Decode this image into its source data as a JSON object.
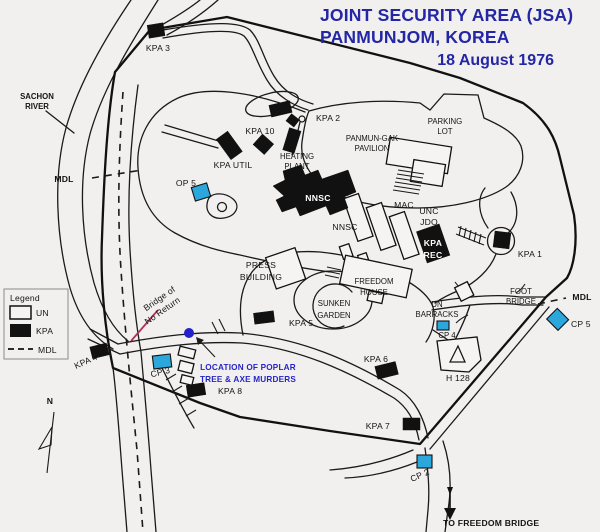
{
  "title": {
    "line1": "JOINT SECURITY AREA (JSA)",
    "line2": "PANMUNJOM, KOREA",
    "date": "18 August 1976"
  },
  "legend": {
    "title": "Legend",
    "un": "UN",
    "kpa": "KPA",
    "mdl": "MDL"
  },
  "compass": {
    "north": "N"
  },
  "labels": {
    "kpa3": "KPA 3",
    "sachon1": "SACHON",
    "sachon2": "RIVER",
    "mdl_left": "MDL",
    "kpa2": "KPA 2",
    "kpa10": "KPA 10",
    "kpa_util": "KPA UTIL",
    "heating1": "HEATING",
    "heating2": "PLANT",
    "panmungak1": "PANMUN-GAK",
    "panmungak2": "PAVILION",
    "parking1": "PARKING",
    "parking2": "LOT",
    "op5": "OP 5",
    "nnsc_main": "NNSC",
    "nnsc_row": "NNSC",
    "mac": "MAC",
    "unc": "UNC",
    "jdo": "JDO",
    "kpa_rec1": "KPA",
    "kpa_rec2": "REC",
    "kpa1": "KPA 1",
    "press1": "PRESS",
    "press2": "BUILDING",
    "freedom1": "FREEDOM",
    "freedom2": "HOUSE",
    "sunken1": "SUNKEN",
    "sunken2": "GARDEN",
    "foot1": "FOOT",
    "foot2": "BRIDGE",
    "mdl_right": "MDL",
    "cp5": "CP 5",
    "un_barracks1": "UN",
    "un_barracks2": "BARRACKS",
    "cp4": "CP 4",
    "h128": "H 128",
    "kpa5": "KPA 5",
    "kpa6": "KPA 6",
    "kpa4": "KPA 4",
    "cp3": "CP 3",
    "kpa8": "KPA 8",
    "kpa7": "KPA 7",
    "cp2": "CP 2",
    "bridge1": "Bridge of",
    "bridge2": "No Return",
    "poplar1": "LOCATION OF POPLAR",
    "poplar2": "TREE & AXE MURDERS",
    "to_freedom_bridge": "TO FREEDOM BRIDGE"
  },
  "colors": {
    "background": "#f2f0ee",
    "title_blue": "#2326a5",
    "annotation_blue": "#2525c6",
    "un_cyan": "#2BA7DC",
    "kpa_black": "#111111",
    "pointer_red": "#b03355",
    "tree_dot_blue": "#2222cc"
  }
}
